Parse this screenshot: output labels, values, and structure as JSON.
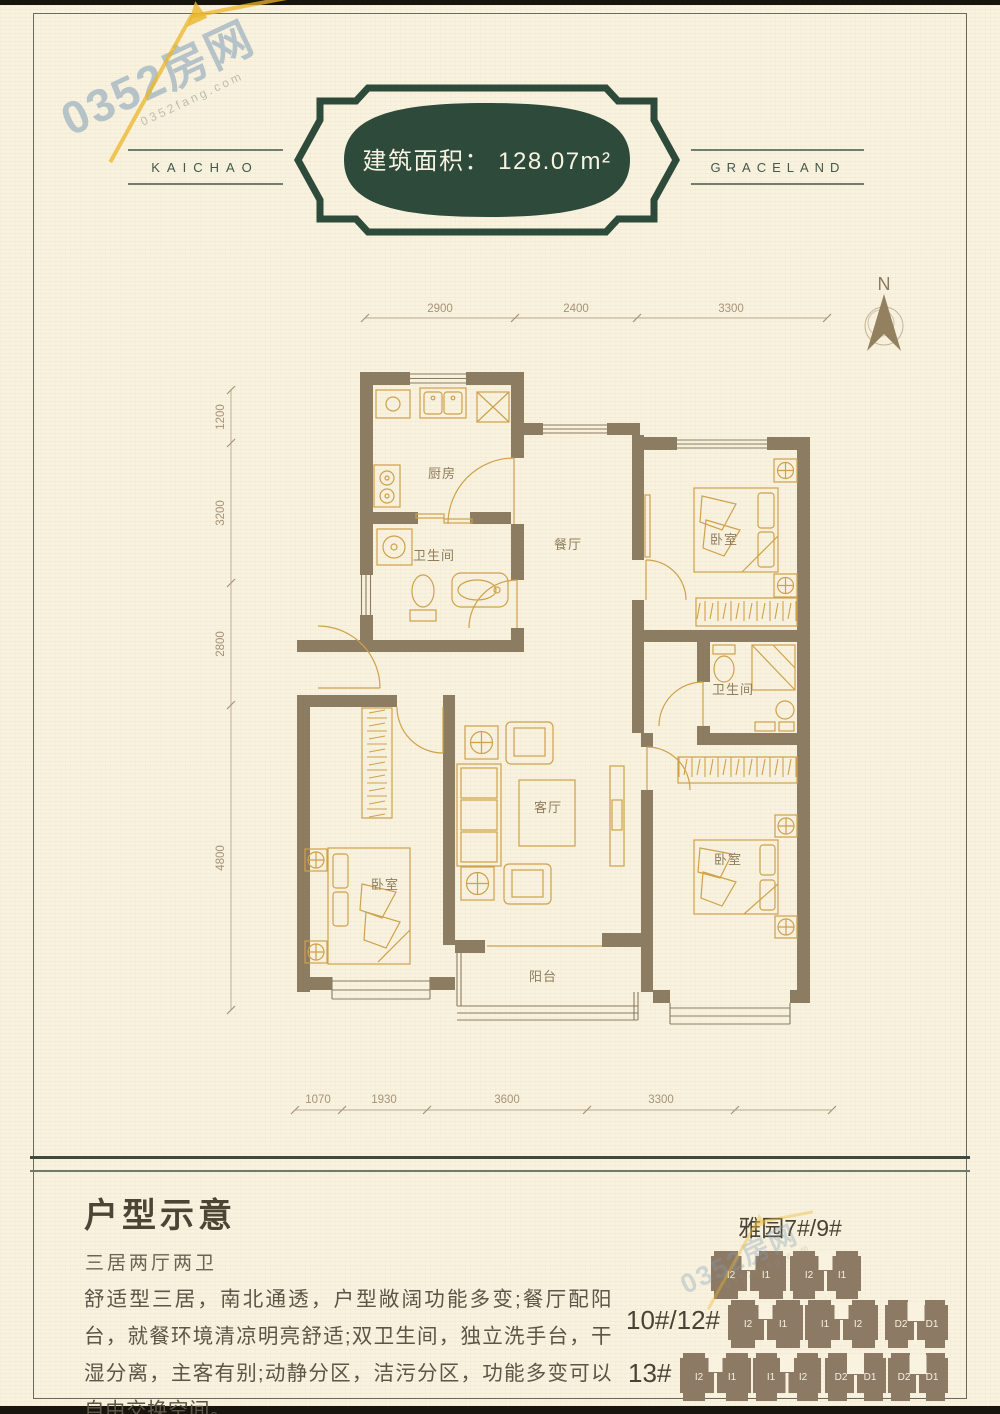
{
  "watermark": {
    "text": "0352房网",
    "subtext": "0352fang.com"
  },
  "header": {
    "brand_left": "KAICHAO",
    "brand_right": "GRACELAND",
    "area_text": "建筑面积： 128.07m²"
  },
  "compass": {
    "label": "N"
  },
  "plan": {
    "dims_top": [
      "2900",
      "2400",
      "3300"
    ],
    "dims_left": [
      "1200",
      "3200",
      "2800",
      "4800"
    ],
    "dims_bottom": [
      "1070",
      "1930",
      "3600",
      "3300"
    ],
    "rooms": {
      "kitchen": "厨房",
      "bath_north": "卫生间",
      "dining": "餐厅",
      "bedroom_ne": "卧室",
      "bath_east": "卫生间",
      "bedroom_se": "卧室",
      "living": "客厅",
      "bedroom_sw": "卧室",
      "balcony": "阳台"
    }
  },
  "footer": {
    "title": "户型示意",
    "subtitle": "三居两厅两卫",
    "description": "舒适型三居，南北通透，户型敞阔功能多变;餐厅配阳台，就餐环境清凉明亮舒适;双卫生间，独立洗手台，干湿分离，主客有别;动静分区，洁污分区，功能多变可以自由交换空间。"
  },
  "buildings": {
    "group1": {
      "label": "雅园7#/9#",
      "blocks": [
        {
          "units": [
            "I2",
            "I1"
          ]
        },
        {
          "units": [
            "I2",
            "I1"
          ]
        }
      ]
    },
    "group2": {
      "label": "10#/12#",
      "blocks": [
        {
          "units": [
            "I2",
            "I1"
          ]
        },
        {
          "units": [
            "I1",
            "I2"
          ]
        },
        {
          "units": [
            "D2",
            "D1"
          ]
        }
      ]
    },
    "group3": {
      "label": "13#",
      "blocks": [
        {
          "units": [
            "I2",
            "I1"
          ]
        },
        {
          "units": [
            "I1",
            "I2"
          ]
        },
        {
          "units": [
            "D2",
            "D1"
          ]
        },
        {
          "units": [
            "D2",
            "D1"
          ]
        }
      ]
    }
  },
  "colors": {
    "badge_green": "#2d4a3a",
    "wall_taupe": "#8c7c62",
    "furniture_gold": "#cfa14b",
    "paper_cream": "#f8f2df",
    "block_brown": "#8d7a64",
    "dim_text": "#a79478"
  }
}
